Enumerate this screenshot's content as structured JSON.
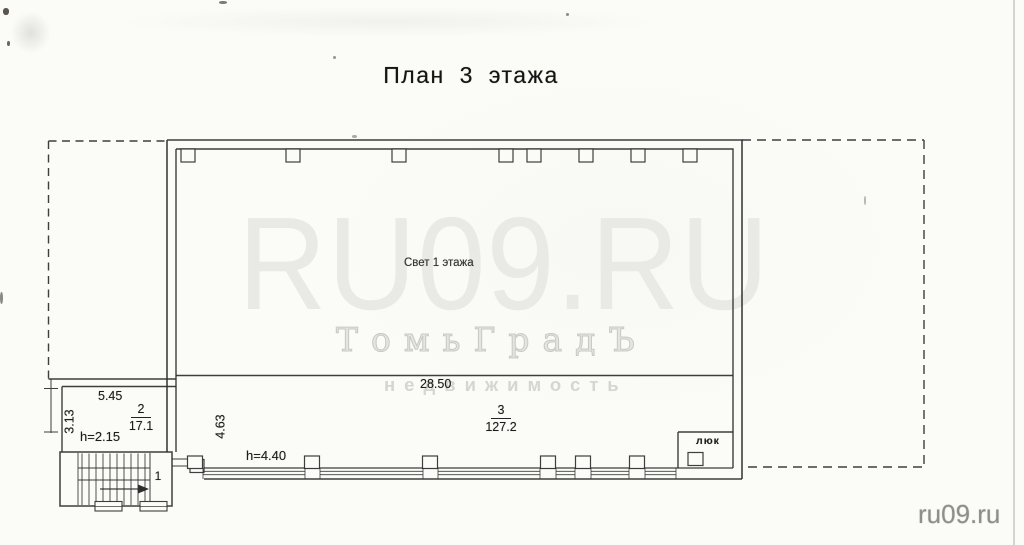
{
  "document": {
    "title": "План 3 этажа"
  },
  "plan": {
    "light_well_label": "Свет 1 этажа",
    "hatch_label": "люк",
    "stairwell_number": "1",
    "rooms": [
      {
        "number": "2",
        "area": "17.1"
      },
      {
        "number": "3",
        "area": "127.2"
      }
    ],
    "dimensions": {
      "room2_width_m": "5.45",
      "room2_depth_m": "3.13",
      "room2_ceiling": "h=2.15",
      "corridor_depth_m": "4.63",
      "corridor_ceiling": "h=4.40",
      "corridor_width_m": "28.50"
    }
  },
  "watermarks": {
    "site_large": "RU09.RU",
    "agency": "ТомьГрадЪ",
    "agency_sub": "недвижимость",
    "site_corner": "ru09.ru"
  },
  "colors": {
    "ink": "#2b2b2b",
    "paper": "#fbfbf7",
    "watermark_light": "#e9e9e5",
    "watermark_outline": "#c8c8c4",
    "watermark_gray": "#8e8e8b"
  }
}
